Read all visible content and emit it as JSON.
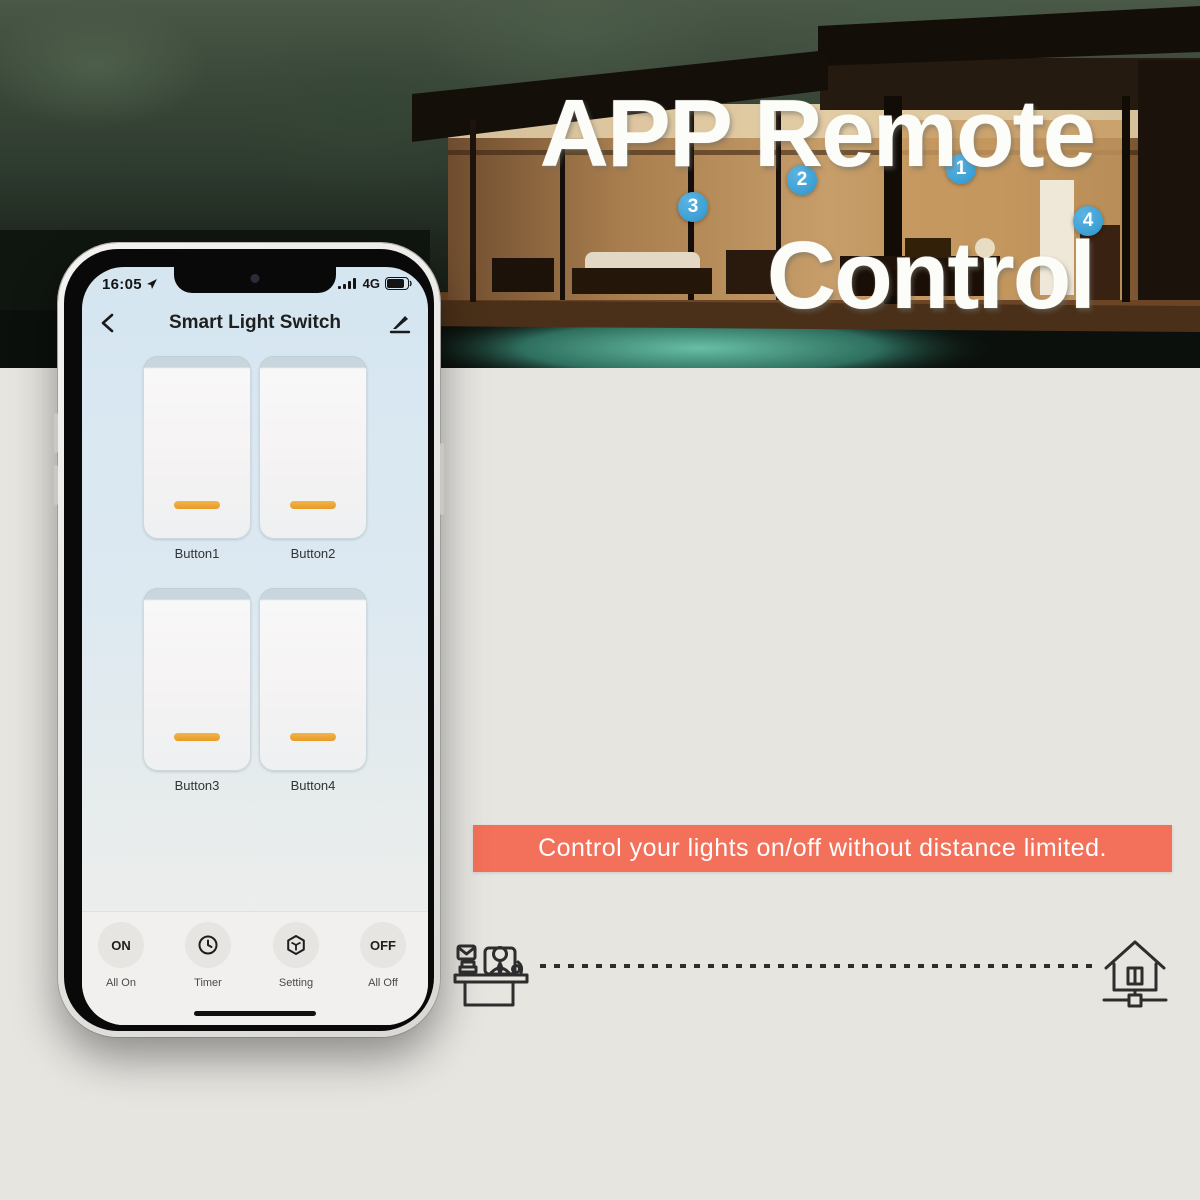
{
  "headline": {
    "line1": "APP Remote",
    "line2": "Control"
  },
  "phone": {
    "status": {
      "time": "16:05",
      "network": "4G"
    },
    "header": {
      "title": "Smart Light Switch"
    },
    "switches": [
      {
        "label": "Button1"
      },
      {
        "label": "Button2"
      },
      {
        "label": "Button3"
      },
      {
        "label": "Button4"
      }
    ],
    "nav": [
      {
        "icon_text": "ON",
        "label": "All On"
      },
      {
        "icon_text": "",
        "label": "Timer"
      },
      {
        "icon_text": "",
        "label": "Setting"
      },
      {
        "icon_text": "OFF",
        "label": "All Off"
      }
    ]
  },
  "photo": {
    "badges": [
      "1",
      "2",
      "3",
      "4"
    ],
    "caption_badge_color": "#3b9fd4"
  },
  "banner": {
    "text": "Control your lights on/off without distance limited."
  },
  "colors": {
    "banner_red": "#f3705a",
    "badge_blue": "#3b9fd4",
    "indicator_orange": "#eda63c",
    "background": "#e7e5e0"
  }
}
